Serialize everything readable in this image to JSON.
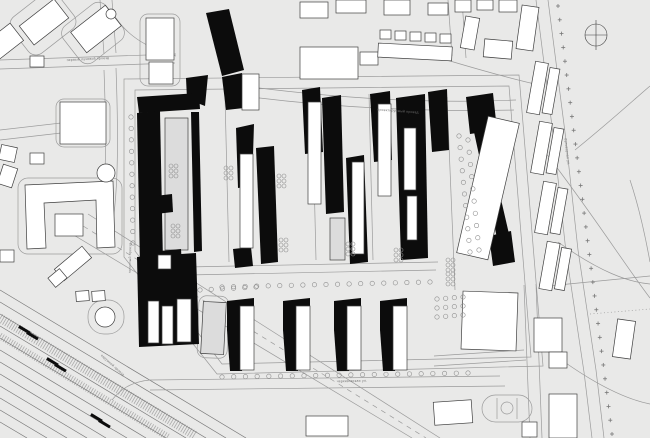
{
  "title": "site-masterplan",
  "colors": {
    "background": "#e9e9e8",
    "road": "#9b9b9b",
    "outline": "#3f3f3f",
    "new_building": "#0c0c0c",
    "existing_fill": "#ffffff",
    "footprint_fill": "#dcdcdc",
    "tree": "#8f8f8f",
    "rail": "#787878",
    "label": "#6f6f6f"
  },
  "labels": [
    {
      "text": "первый лучевой проезд",
      "x": 88,
      "y": 60,
      "rot": -3
    },
    {
      "text": "проектируемый проезд",
      "x": 398,
      "y": 112,
      "rot": 4
    },
    {
      "text": "погонный проезд",
      "x": 131,
      "y": 258,
      "rot": -89
    },
    {
      "text": "бульварная ул.",
      "x": 566,
      "y": 152,
      "rot": 83
    },
    {
      "text": "черкизовская ул.",
      "x": 352,
      "y": 382,
      "rot": -1
    },
    {
      "text": "окружной проезд",
      "x": 112,
      "y": 366,
      "rot": 42
    }
  ],
  "north_arrow": {
    "cx": 596,
    "cy": 35,
    "r": 11
  },
  "roads": [
    "M0,60 L176,54",
    "M0,69 L175,63",
    "M100,0 L104,54",
    "M112,0 L116,53",
    "M104,70 C107,150 106,210 97,236",
    "M116,68 C119,150 118,212 108,244",
    "M0,130 L96,119",
    "M0,140 L96,129",
    "M176,56 C150,50 128,36 116,18",
    "M440,58 C480,70 515,80 544,86",
    "M448,0 L452,56",
    "M462,0 L466,58",
    "M124,79 L519,75 L543,366 L217,374 L124,257 Z",
    "M135,90 L509,86 L531,357 L222,364 L135,251 Z",
    "M228,84 C330,98 430,104 516,100",
    "M228,94 C330,108 426,112 514,110",
    "M138,268 L438,262",
    "M138,276 L436,270",
    "M225,96 L229,262",
    "M312,92 L316,260",
    "M369,94 L373,260",
    "M447,97 L455,290",
    "M548,0 L566,140 L578,250 L596,370 L604,438",
    "M536,0 L554,142 L566,252 L584,372 L592,438",
    "M150,380 L500,376",
    "M150,390 L505,386",
    "M150,380 C130,382 120,390 112,400",
    "M62,228 L412,438",
    "M88,214 L440,438",
    "M524,285 L530,438",
    "M536,284 L542,438",
    "M434,356 L524,350",
    "M434,366 L526,360",
    "M548,286 L650,276",
    "M545,152 C590,210 625,265 650,298",
    "M558,242 C600,272 628,282 650,284",
    "M575,150 C612,120 638,96 650,86",
    "M548,350 C585,378 620,398 650,404",
    "M630,180 C640,210 646,240 650,262"
  ],
  "dashed_roads": [
    {
      "d": "M75,221 L426,438",
      "dash": "5,5"
    },
    {
      "d": "M590,314 L650,309",
      "dash": "1,2.5"
    }
  ],
  "plots": [
    {
      "x": 14,
      "y": 0,
      "w": 58,
      "h": 46,
      "rot": -38,
      "rx": 10
    },
    {
      "x": 66,
      "y": 10,
      "w": 54,
      "h": 46,
      "rot": -38,
      "rx": 10
    },
    {
      "x": 56,
      "y": 99,
      "w": 54,
      "h": 48,
      "rot": 0,
      "rx": 8
    },
    {
      "x": 18,
      "y": 178,
      "w": 104,
      "h": 76,
      "rot": 0,
      "rx": 10
    },
    {
      "x": 140,
      "y": 14,
      "w": 40,
      "h": 72,
      "rot": 0,
      "rx": 8
    },
    {
      "x": 88,
      "y": 300,
      "w": 36,
      "h": 34,
      "rot": 0,
      "rx": 16
    },
    {
      "x": 198,
      "y": 296,
      "w": 30,
      "h": 62,
      "rot": 2,
      "rx": 8
    }
  ],
  "circles": [
    {
      "cx": 106,
      "cy": 173,
      "r": 9
    },
    {
      "cx": 105,
      "cy": 317,
      "r": 10
    },
    {
      "cx": 111,
      "cy": 14,
      "r": 5
    }
  ],
  "buildings": [
    [
      22,
      10,
      44,
      24,
      -38
    ],
    [
      74,
      16,
      44,
      26,
      -38
    ],
    [
      -10,
      30,
      30,
      22,
      -38
    ],
    [
      146,
      18,
      28,
      42,
      0
    ],
    [
      149,
      62,
      24,
      22,
      0
    ],
    [
      30,
      56,
      14,
      11,
      0
    ],
    [
      60,
      102,
      46,
      42,
      0
    ],
    [
      300,
      2,
      28,
      16,
      0
    ],
    [
      336,
      0,
      30,
      13,
      0
    ],
    [
      384,
      0,
      26,
      15,
      0
    ],
    [
      428,
      3,
      20,
      12,
      0
    ],
    [
      300,
      47,
      58,
      32,
      0
    ],
    [
      360,
      52,
      18,
      13,
      0
    ],
    [
      378,
      45,
      74,
      14,
      3
    ],
    [
      380,
      30,
      11,
      9,
      0
    ],
    [
      395,
      31,
      11,
      9,
      0
    ],
    [
      410,
      32,
      11,
      9,
      0
    ],
    [
      425,
      33,
      11,
      9,
      0
    ],
    [
      440,
      34,
      11,
      9,
      0
    ],
    [
      455,
      0,
      16,
      12,
      0
    ],
    [
      477,
      0,
      16,
      10,
      0
    ],
    [
      499,
      0,
      18,
      12,
      0
    ],
    [
      519,
      6,
      17,
      44,
      8
    ],
    [
      463,
      17,
      14,
      32,
      10
    ],
    [
      484,
      40,
      28,
      18,
      5
    ],
    [
      531,
      62,
      13,
      52,
      10
    ],
    [
      535,
      122,
      13,
      52,
      10
    ],
    [
      539,
      182,
      13,
      52,
      10
    ],
    [
      543,
      242,
      13,
      48,
      10
    ],
    [
      546,
      68,
      10,
      46,
      10
    ],
    [
      550,
      128,
      10,
      46,
      10
    ],
    [
      554,
      188,
      10,
      46,
      10
    ],
    [
      558,
      248,
      10,
      42,
      10
    ],
    [
      0,
      146,
      16,
      15,
      12
    ],
    [
      0,
      166,
      15,
      20,
      18
    ],
    [
      30,
      153,
      14,
      11,
      0
    ],
    [
      55,
      256,
      36,
      15,
      -40
    ],
    [
      50,
      272,
      15,
      12,
      -40
    ],
    [
      0,
      250,
      14,
      12,
      0
    ],
    [
      76,
      291,
      13,
      10,
      -4
    ],
    [
      92,
      291,
      13,
      10,
      -4
    ],
    [
      306,
      416,
      42,
      20,
      0
    ],
    [
      434,
      401,
      38,
      23,
      -4
    ],
    [
      462,
      292,
      55,
      58,
      2
    ],
    [
      534,
      318,
      28,
      34,
      0
    ],
    [
      549,
      352,
      18,
      16,
      0
    ],
    [
      615,
      320,
      18,
      38,
      8
    ],
    [
      549,
      394,
      28,
      44,
      0
    ],
    [
      522,
      422,
      15,
      15,
      0
    ]
  ],
  "u_building": "M25,185 L113,181 L115,247 L97,248 L96,200 L44,203 L46,248 L27,249 Z",
  "inner_building": [
    55,
    214,
    28,
    22,
    0
  ],
  "footprints": [
    [
      165,
      118,
      23,
      132,
      0
    ],
    [
      330,
      218,
      15,
      42,
      0
    ],
    [
      202,
      302,
      23,
      52,
      3
    ],
    [
      234,
      312,
      11,
      30,
      0
    ],
    [
      290,
      312,
      11,
      30,
      0
    ],
    [
      341,
      312,
      11,
      30,
      0
    ],
    [
      387,
      312,
      11,
      30,
      0
    ]
  ],
  "new_buildings": [
    [
      [
        206,
        13
      ],
      [
        229,
        9
      ],
      [
        244,
        70
      ],
      [
        222,
        76
      ]
    ],
    [
      [
        222,
        77
      ],
      [
        242,
        73
      ],
      [
        244,
        108
      ],
      [
        226,
        110
      ]
    ],
    [
      [
        186,
        78
      ],
      [
        208,
        75
      ],
      [
        205,
        106
      ],
      [
        187,
        99
      ]
    ],
    [
      [
        137,
        97
      ],
      [
        199,
        93
      ],
      [
        200,
        109
      ],
      [
        139,
        113
      ]
    ],
    [
      [
        137,
        113
      ],
      [
        160,
        111
      ],
      [
        163,
        263
      ],
      [
        140,
        266
      ]
    ],
    [
      [
        191,
        112
      ],
      [
        199,
        112
      ],
      [
        202,
        251
      ],
      [
        194,
        252
      ]
    ],
    [
      [
        155,
        196
      ],
      [
        172,
        194
      ],
      [
        173,
        212
      ],
      [
        156,
        214
      ]
    ],
    [
      [
        160,
        251
      ],
      [
        181,
        249
      ],
      [
        182,
        266
      ],
      [
        161,
        268
      ]
    ],
    [
      [
        137,
        257
      ],
      [
        196,
        253
      ],
      [
        199,
        344
      ],
      [
        139,
        347
      ]
    ],
    [
      [
        236,
        128
      ],
      [
        254,
        124
      ],
      [
        252,
        186
      ],
      [
        238,
        188
      ]
    ],
    [
      [
        256,
        148
      ],
      [
        274,
        146
      ],
      [
        278,
        262
      ],
      [
        261,
        264
      ]
    ],
    [
      [
        233,
        249
      ],
      [
        251,
        247
      ],
      [
        253,
        266
      ],
      [
        235,
        268
      ]
    ],
    [
      [
        302,
        90
      ],
      [
        320,
        87
      ],
      [
        323,
        152
      ],
      [
        305,
        154
      ]
    ],
    [
      [
        322,
        98
      ],
      [
        341,
        95
      ],
      [
        344,
        212
      ],
      [
        326,
        214
      ]
    ],
    [
      [
        346,
        158
      ],
      [
        364,
        155
      ],
      [
        368,
        262
      ],
      [
        350,
        264
      ]
    ],
    [
      [
        370,
        94
      ],
      [
        390,
        91
      ],
      [
        392,
        160
      ],
      [
        374,
        162
      ]
    ],
    [
      [
        396,
        98
      ],
      [
        425,
        94
      ],
      [
        428,
        258
      ],
      [
        401,
        260
      ]
    ],
    [
      [
        428,
        92
      ],
      [
        447,
        89
      ],
      [
        449,
        150
      ],
      [
        432,
        152
      ]
    ],
    [
      [
        466,
        97
      ],
      [
        493,
        93
      ],
      [
        497,
        130
      ],
      [
        470,
        134
      ]
    ],
    [
      [
        474,
        132
      ],
      [
        485,
        130
      ],
      [
        509,
        234
      ],
      [
        497,
        238
      ]
    ],
    [
      [
        489,
        236
      ],
      [
        511,
        231
      ],
      [
        515,
        262
      ],
      [
        493,
        266
      ]
    ],
    [
      [
        227,
        301
      ],
      [
        254,
        298
      ],
      [
        254,
        313
      ],
      [
        242,
        371
      ],
      [
        230,
        371
      ],
      [
        227,
        330
      ]
    ],
    [
      [
        283,
        301
      ],
      [
        310,
        298
      ],
      [
        310,
        313
      ],
      [
        298,
        371
      ],
      [
        286,
        371
      ],
      [
        283,
        330
      ]
    ],
    [
      [
        334,
        301
      ],
      [
        361,
        298
      ],
      [
        361,
        313
      ],
      [
        349,
        371
      ],
      [
        337,
        371
      ],
      [
        334,
        330
      ]
    ],
    [
      [
        380,
        301
      ],
      [
        407,
        298
      ],
      [
        407,
        313
      ],
      [
        395,
        371
      ],
      [
        383,
        371
      ],
      [
        380,
        330
      ]
    ]
  ],
  "towers": [
    [
      242,
      74,
      17,
      36,
      0
    ],
    [
      158,
      255,
      13,
      14,
      0
    ],
    [
      148,
      301,
      11,
      42,
      0
    ],
    [
      162,
      306,
      11,
      38,
      0
    ],
    [
      177,
      299,
      14,
      43,
      0
    ],
    [
      240,
      306,
      14,
      64,
      0
    ],
    [
      296,
      306,
      14,
      64,
      0
    ],
    [
      347,
      306,
      14,
      64,
      0
    ],
    [
      393,
      306,
      14,
      64,
      0
    ],
    [
      240,
      154,
      13,
      94,
      0
    ],
    [
      308,
      102,
      13,
      102,
      0
    ],
    [
      352,
      162,
      12,
      92,
      0
    ],
    [
      378,
      104,
      13,
      92,
      0
    ],
    [
      404,
      128,
      12,
      62,
      0
    ],
    [
      407,
      196,
      10,
      44,
      0
    ],
    [
      472,
      118,
      32,
      140,
      13
    ]
  ],
  "tree_rows": [
    {
      "x1": 222,
      "y1": 287,
      "x2": 430,
      "y2": 282,
      "n": 19
    },
    {
      "x1": 222,
      "y1": 377,
      "x2": 468,
      "y2": 373,
      "n": 22
    },
    {
      "x1": 131,
      "y1": 117,
      "x2": 133,
      "y2": 243,
      "n": 12
    },
    {
      "x1": 459,
      "y1": 136,
      "x2": 470,
      "y2": 252,
      "n": 11
    },
    {
      "x1": 468,
      "y1": 140,
      "x2": 479,
      "y2": 250,
      "n": 10
    },
    {
      "x1": 200,
      "y1": 290,
      "x2": 256,
      "y2": 287,
      "n": 6
    },
    {
      "x1": 437,
      "y1": 299,
      "x2": 463,
      "y2": 297,
      "n": 4
    },
    {
      "x1": 437,
      "y1": 308,
      "x2": 463,
      "y2": 306,
      "n": 4
    },
    {
      "x1": 437,
      "y1": 317,
      "x2": 463,
      "y2": 315,
      "n": 4
    }
  ],
  "tree_clusters": [
    [
      171,
      166
    ],
    [
      173,
      226
    ],
    [
      279,
      176
    ],
    [
      281,
      240
    ],
    [
      348,
      244
    ],
    [
      396,
      250
    ],
    [
      448,
      260
    ],
    [
      448,
      274
    ],
    [
      226,
      168
    ]
  ],
  "tick_row": {
    "x1": 558,
    "y1": 6,
    "x2": 612,
    "y2": 434,
    "n": 32
  },
  "railway": {
    "lines": [
      [
        0,
        290,
        246,
        438
      ],
      [
        0,
        302,
        226,
        438
      ],
      [
        0,
        314,
        206,
        438
      ],
      [
        0,
        326,
        186,
        438
      ],
      [
        0,
        338,
        166,
        438
      ],
      [
        0,
        350,
        146,
        438
      ],
      [
        0,
        362,
        127,
        438
      ],
      [
        0,
        374,
        106,
        438
      ],
      [
        0,
        386,
        87,
        438
      ],
      [
        0,
        398,
        67,
        438
      ],
      [
        0,
        410,
        47,
        438
      ],
      [
        0,
        422,
        27,
        438
      ]
    ],
    "hatches": [
      {
        "x1": 0,
        "y1": 318,
        "x2": 196,
        "y2": 436,
        "w": 9
      },
      {
        "x1": 0,
        "y1": 336,
        "x2": 168,
        "y2": 437,
        "w": 7
      }
    ],
    "cars": [
      [
        18,
        328
      ],
      [
        26,
        334
      ],
      [
        46,
        360
      ],
      [
        54,
        366
      ],
      [
        90,
        416
      ],
      [
        98,
        422
      ]
    ]
  },
  "stadium": {
    "x": 482,
    "y": 395,
    "w": 50,
    "h": 27,
    "cx": 507,
    "cy": 408,
    "r": 6
  }
}
